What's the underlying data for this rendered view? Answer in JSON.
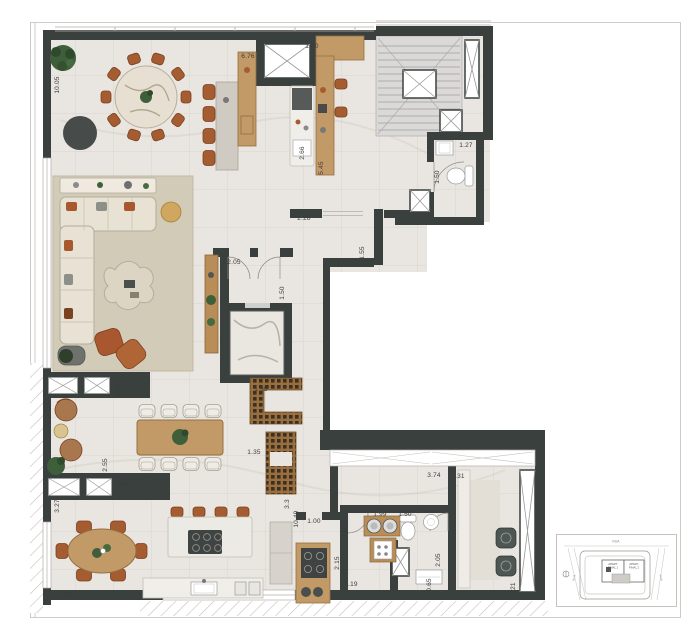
{
  "drawing": {
    "type": "apartment floor plan",
    "dimension_unit": "m",
    "dimensions": [
      {
        "text": "10.05",
        "x": 58,
        "y": 85,
        "v": true
      },
      {
        "text": "6.76",
        "x": 248,
        "y": 57,
        "v": false
      },
      {
        "text": "1.50",
        "x": 312,
        "y": 47,
        "v": false
      },
      {
        "text": "2.66",
        "x": 303,
        "y": 153,
        "v": true
      },
      {
        "text": "5.45",
        "x": 322,
        "y": 168,
        "v": true
      },
      {
        "text": "1.27",
        "x": 466,
        "y": 146,
        "v": false
      },
      {
        "text": "1.50",
        "x": 438,
        "y": 177,
        "v": true
      },
      {
        "text": "2.28",
        "x": 304,
        "y": 219,
        "v": false
      },
      {
        "text": "2.05",
        "x": 234,
        "y": 263,
        "v": false
      },
      {
        "text": "1.50",
        "x": 283,
        "y": 293,
        "v": true
      },
      {
        "text": "1.55",
        "x": 363,
        "y": 253,
        "v": true
      },
      {
        "text": "1.35",
        "x": 261,
        "y": 390,
        "v": false
      },
      {
        "text": "1.35",
        "x": 254,
        "y": 453,
        "v": false
      },
      {
        "text": "3.55",
        "x": 120,
        "y": 391,
        "v": true
      },
      {
        "text": "2.55",
        "x": 106,
        "y": 465,
        "v": true
      },
      {
        "text": "5.80",
        "x": 124,
        "y": 486,
        "v": false
      },
      {
        "text": "3.27",
        "x": 58,
        "y": 506,
        "v": true
      },
      {
        "text": "7.80",
        "x": 64,
        "y": 594,
        "v": false
      },
      {
        "text": "1.10",
        "x": 334,
        "y": 479,
        "v": true
      },
      {
        "text": "3.3",
        "x": 288,
        "y": 504,
        "v": true
      },
      {
        "text": "10.49",
        "x": 297,
        "y": 519,
        "v": true
      },
      {
        "text": "1.00",
        "x": 314,
        "y": 522,
        "v": false
      },
      {
        "text": "2.15",
        "x": 338,
        "y": 563,
        "v": true
      },
      {
        "text": "1.99",
        "x": 380,
        "y": 515,
        "v": false
      },
      {
        "text": "1.50",
        "x": 405,
        "y": 515,
        "v": false
      },
      {
        "text": "3.74",
        "x": 434,
        "y": 476,
        "v": false
      },
      {
        "text": "2.31",
        "x": 458,
        "y": 477,
        "v": false
      },
      {
        "text": "2.05",
        "x": 439,
        "y": 560,
        "v": true
      },
      {
        "text": "0.65",
        "x": 430,
        "y": 585,
        "v": true
      },
      {
        "text": "3.19",
        "x": 351,
        "y": 585,
        "v": false
      },
      {
        "text": "4.21",
        "x": 514,
        "y": 589,
        "v": true
      }
    ],
    "key_plan": {
      "street_top": "RUA",
      "street_left": "RUA",
      "street_right": "RUA",
      "unit1_line1": "APART.",
      "unit1_line2": "FINAL 1",
      "unit2_line1": "APART.",
      "unit2_line2": "FINAL 2"
    },
    "palette": {
      "wall": "#3a403e",
      "floor": "#e9e6e1",
      "wood": "#c19a67",
      "rug": "#d2cbb8",
      "chair_brown": "#a45c30",
      "greenery": "#3f5f3a",
      "stone": "#e7e0d2"
    }
  }
}
